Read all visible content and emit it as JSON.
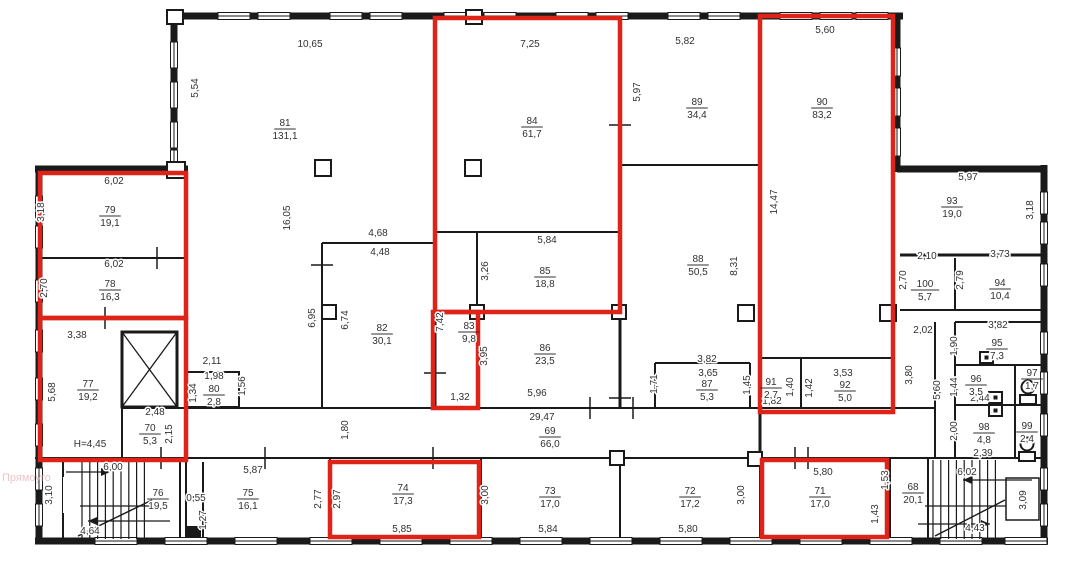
{
  "drawing": {
    "type": "floor-plan",
    "watermark": "Прямоуго",
    "colors": {
      "highlight": "#de2318",
      "line": "#1a1a1a",
      "text": "#303030",
      "watermark": "#dca8a8"
    },
    "height_note": "H=4,45",
    "rooms": [
      {
        "n": "81",
        "a": "131,1",
        "x": 285,
        "y": 128
      },
      {
        "n": "84",
        "a": "61,7",
        "x": 532,
        "y": 126
      },
      {
        "n": "89",
        "a": "34,4",
        "x": 697,
        "y": 107
      },
      {
        "n": "90",
        "a": "83,2",
        "x": 822,
        "y": 107
      },
      {
        "n": "79",
        "a": "19,1",
        "x": 110,
        "y": 215
      },
      {
        "n": "78",
        "a": "16,3",
        "x": 110,
        "y": 289
      },
      {
        "n": "77",
        "a": "19,2",
        "x": 88,
        "y": 389
      },
      {
        "n": "70",
        "a": "5,3",
        "x": 150,
        "y": 433
      },
      {
        "n": "80",
        "a": "2,8",
        "x": 214,
        "y": 394
      },
      {
        "n": "82",
        "a": "30,1",
        "x": 382,
        "y": 333
      },
      {
        "n": "83",
        "a": "9,8",
        "x": 469,
        "y": 331
      },
      {
        "n": "85",
        "a": "18,8",
        "x": 545,
        "y": 276
      },
      {
        "n": "86",
        "a": "23,5",
        "x": 545,
        "y": 353
      },
      {
        "n": "88",
        "a": "50,5",
        "x": 698,
        "y": 264
      },
      {
        "n": "87",
        "a": "5,3",
        "x": 707,
        "y": 389
      },
      {
        "n": "91",
        "a": "2,7",
        "x": 771,
        "y": 387
      },
      {
        "n": "92",
        "a": "5,0",
        "x": 845,
        "y": 390
      },
      {
        "n": "93",
        "a": "19,0",
        "x": 952,
        "y": 206
      },
      {
        "n": "100",
        "a": "5,7",
        "x": 925,
        "y": 289
      },
      {
        "n": "94",
        "a": "10,4",
        "x": 1000,
        "y": 288
      },
      {
        "n": "95",
        "a": "7,3",
        "x": 997,
        "y": 348
      },
      {
        "n": "96",
        "a": "3,5",
        "x": 976,
        "y": 384
      },
      {
        "n": "97",
        "a": "1,7",
        "x": 1032,
        "y": 378
      },
      {
        "n": "98",
        "a": "4,8",
        "x": 984,
        "y": 432
      },
      {
        "n": "99",
        "a": "2,4",
        "x": 1027,
        "y": 431
      },
      {
        "n": "76",
        "a": "19,5",
        "x": 158,
        "y": 498
      },
      {
        "n": "75",
        "a": "16,1",
        "x": 248,
        "y": 498
      },
      {
        "n": "74",
        "a": "17,3",
        "x": 403,
        "y": 493
      },
      {
        "n": "73",
        "a": "17,0",
        "x": 550,
        "y": 496
      },
      {
        "n": "72",
        "a": "17,2",
        "x": 690,
        "y": 496
      },
      {
        "n": "71",
        "a": "17,0",
        "x": 820,
        "y": 496
      },
      {
        "n": "68",
        "a": "20,1",
        "x": 913,
        "y": 492
      },
      {
        "n": "69",
        "a": "66,0",
        "x": 550,
        "y": 436
      }
    ],
    "dims": [
      {
        "t": "10,65",
        "x": 310,
        "y": 47
      },
      {
        "t": "7,25",
        "x": 530,
        "y": 47
      },
      {
        "t": "5,82",
        "x": 685,
        "y": 44
      },
      {
        "t": "5,60",
        "x": 825,
        "y": 33
      },
      {
        "t": "5,54",
        "x": 198,
        "y": 88,
        "v": 1
      },
      {
        "t": "5,97",
        "x": 640,
        "y": 92,
        "v": 1
      },
      {
        "t": "16,05",
        "x": 290,
        "y": 218,
        "v": 1
      },
      {
        "t": "6,02",
        "x": 114,
        "y": 184
      },
      {
        "t": "3,18",
        "x": 44,
        "y": 212,
        "v": 1
      },
      {
        "t": "6,02",
        "x": 114,
        "y": 267
      },
      {
        "t": "2,70",
        "x": 47,
        "y": 288,
        "v": 1
      },
      {
        "t": "3,38",
        "x": 77,
        "y": 338
      },
      {
        "t": "5,68",
        "x": 55,
        "y": 392,
        "v": 1
      },
      {
        "t": "2,48",
        "x": 155,
        "y": 415
      },
      {
        "t": "2,15",
        "x": 172,
        "y": 434,
        "v": 1
      },
      {
        "t": "H=4,45",
        "x": 90,
        "y": 447
      },
      {
        "t": "2,11",
        "x": 212,
        "y": 364
      },
      {
        "t": "1,98",
        "x": 214,
        "y": 379
      },
      {
        "t": "1,34",
        "x": 196,
        "y": 393,
        "v": 1
      },
      {
        "t": "1,56",
        "x": 245,
        "y": 386,
        "v": 1
      },
      {
        "t": "4,68",
        "x": 378,
        "y": 236
      },
      {
        "t": "4,48",
        "x": 380,
        "y": 255
      },
      {
        "t": "6,95",
        "x": 315,
        "y": 318,
        "v": 1
      },
      {
        "t": "6,74",
        "x": 348,
        "y": 320,
        "v": 1
      },
      {
        "t": "5,84",
        "x": 547,
        "y": 243
      },
      {
        "t": "3,26",
        "x": 488,
        "y": 271,
        "v": 1
      },
      {
        "t": "7,42",
        "x": 443,
        "y": 322,
        "v": 1
      },
      {
        "t": "3,95",
        "x": 487,
        "y": 356,
        "v": 1
      },
      {
        "t": "1,32",
        "x": 460,
        "y": 400
      },
      {
        "t": "5,96",
        "x": 537,
        "y": 396
      },
      {
        "t": "29,47",
        "x": 542,
        "y": 420
      },
      {
        "t": "1,80",
        "x": 348,
        "y": 430,
        "v": 1
      },
      {
        "t": "14,47",
        "x": 777,
        "y": 202,
        "v": 1
      },
      {
        "t": "8,31",
        "x": 737,
        "y": 266,
        "v": 1
      },
      {
        "t": "3,82",
        "x": 707,
        "y": 362
      },
      {
        "t": "3,65",
        "x": 708,
        "y": 376
      },
      {
        "t": "1,71",
        "x": 657,
        "y": 384,
        "v": 1
      },
      {
        "t": "1,45",
        "x": 750,
        "y": 385,
        "v": 1
      },
      {
        "t": "1,82",
        "x": 772,
        "y": 404
      },
      {
        "t": "1,40",
        "x": 793,
        "y": 387,
        "v": 1
      },
      {
        "t": "1,42",
        "x": 812,
        "y": 388,
        "v": 1
      },
      {
        "t": "3,53",
        "x": 843,
        "y": 376
      },
      {
        "t": "5,97",
        "x": 968,
        "y": 180
      },
      {
        "t": "3,18",
        "x": 1033,
        "y": 210,
        "v": 1
      },
      {
        "t": "2,10",
        "x": 927,
        "y": 259
      },
      {
        "t": "2,70",
        "x": 906,
        "y": 280,
        "v": 1
      },
      {
        "t": "2,79",
        "x": 963,
        "y": 280,
        "v": 1
      },
      {
        "t": "3,73",
        "x": 1000,
        "y": 257
      },
      {
        "t": "2,02",
        "x": 923,
        "y": 333
      },
      {
        "t": "3,82",
        "x": 998,
        "y": 328
      },
      {
        "t": "1,90",
        "x": 957,
        "y": 346,
        "v": 1
      },
      {
        "t": "3,80",
        "x": 912,
        "y": 375,
        "v": 1
      },
      {
        "t": "5,60",
        "x": 940,
        "y": 390,
        "v": 1
      },
      {
        "t": "1,44",
        "x": 957,
        "y": 387,
        "v": 1
      },
      {
        "t": "2,44",
        "x": 980,
        "y": 401
      },
      {
        "t": "2,00",
        "x": 957,
        "y": 431,
        "v": 1
      },
      {
        "t": "2,39",
        "x": 983,
        "y": 456
      },
      {
        "t": "6,00",
        "x": 113,
        "y": 470
      },
      {
        "t": "3,10",
        "x": 52,
        "y": 495,
        "v": 1
      },
      {
        "t": "4,64",
        "x": 90,
        "y": 534
      },
      {
        "t": "5,87",
        "x": 253,
        "y": 473
      },
      {
        "t": "0,55",
        "x": 196,
        "y": 501
      },
      {
        "t": "1,27",
        "x": 206,
        "y": 520,
        "v": 1
      },
      {
        "t": "2,77",
        "x": 321,
        "y": 499,
        "v": 1
      },
      {
        "t": "2,97",
        "x": 340,
        "y": 499,
        "v": 1
      },
      {
        "t": "5,85",
        "x": 402,
        "y": 532
      },
      {
        "t": "3,00",
        "x": 488,
        "y": 495,
        "v": 1
      },
      {
        "t": "5,84",
        "x": 548,
        "y": 532
      },
      {
        "t": "5,80",
        "x": 688,
        "y": 532
      },
      {
        "t": "3,00",
        "x": 744,
        "y": 495,
        "v": 1
      },
      {
        "t": "5,80",
        "x": 823,
        "y": 475
      },
      {
        "t": "1,53",
        "x": 888,
        "y": 480,
        "v": 1
      },
      {
        "t": "1,43",
        "x": 878,
        "y": 514,
        "v": 1
      },
      {
        "t": "6,02",
        "x": 967,
        "y": 475
      },
      {
        "t": "4,43",
        "x": 975,
        "y": 531
      },
      {
        "t": "3,09",
        "x": 1026,
        "y": 500,
        "v": 1
      }
    ],
    "highlight_boxes": [
      [
        40,
        173,
        146,
        145
      ],
      [
        40,
        318,
        146,
        142
      ],
      [
        435,
        18,
        185,
        294
      ],
      [
        433,
        312,
        45,
        96
      ],
      [
        760,
        16,
        133,
        396
      ],
      [
        330,
        462,
        149,
        75
      ],
      [
        762,
        460,
        125,
        77
      ]
    ]
  }
}
